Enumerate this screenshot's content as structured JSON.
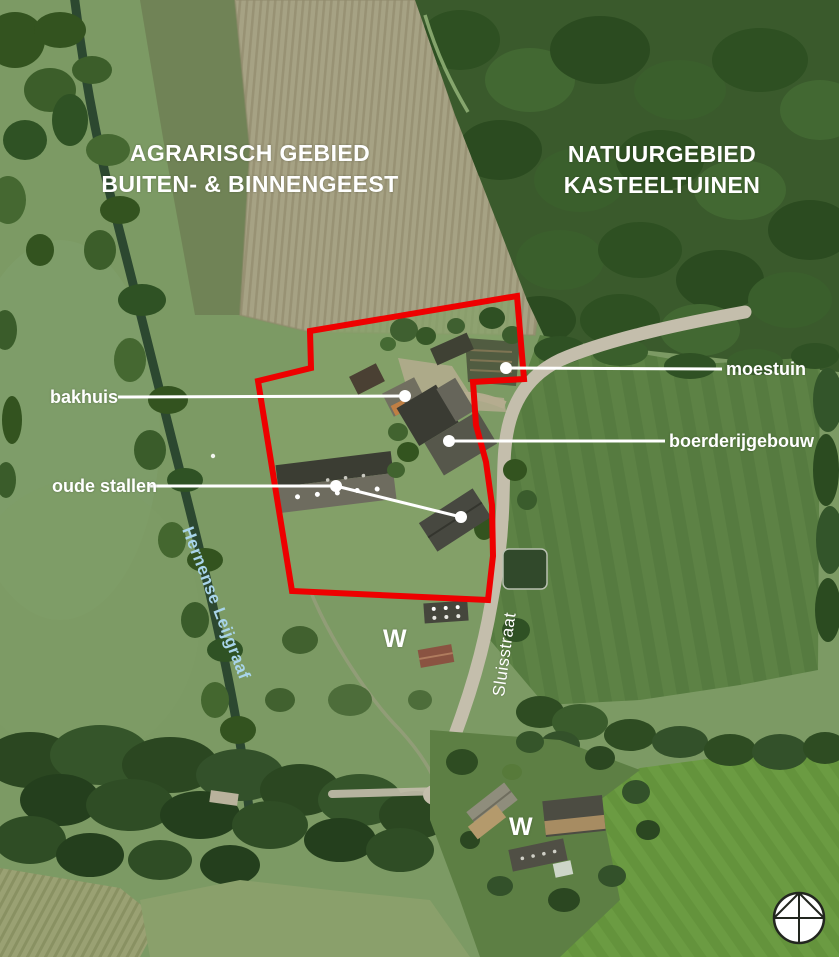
{
  "map": {
    "region_labels": {
      "agrarisch": {
        "line1": "AGRARISCH GEBIED",
        "line2": "BUITEN- & BINNENGEEST"
      },
      "natuur": {
        "line1": "NATUURGEBIED",
        "line2": "KASTEELTUINEN"
      }
    },
    "feature_labels": {
      "bakhuis": "bakhuis",
      "oude_stallen": "oude stallen",
      "moestuin": "moestuin",
      "boerderijgebouw": "boerderijgebouw"
    },
    "street_labels": {
      "waterway": "Hernense Leijgraaf",
      "street": "Sluisstraat"
    },
    "markers": {
      "w_north": "W",
      "w_south": "W"
    },
    "icons": {
      "north_arrow": "north-arrow-compass"
    },
    "colors": {
      "boundary_red": "#ee0000",
      "leader_white": "#ffffff",
      "waterway_label_blue": "#a8d4ea",
      "label_white": "#ffffff"
    }
  }
}
